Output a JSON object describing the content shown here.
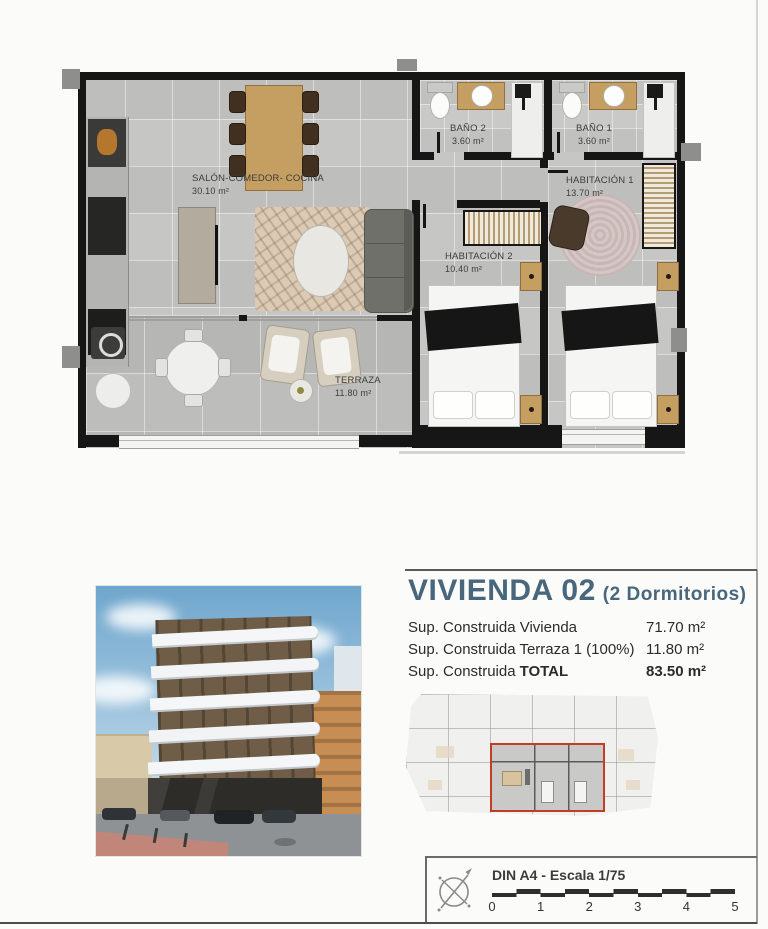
{
  "floorplan": {
    "rooms": [
      {
        "id": "salon",
        "name": "SALÓN-COMEDOR- COCINA",
        "area": "30.10 m²"
      },
      {
        "id": "terraza",
        "name": "TERRAZA",
        "area": "11.80 m²"
      },
      {
        "id": "bano2",
        "name": "BAÑO 2",
        "area": "3.60 m²"
      },
      {
        "id": "bano1",
        "name": "BAÑO 1",
        "area": "3.60 m²"
      },
      {
        "id": "hab1",
        "name": "HABITACIÓN 1",
        "area": "13.70 m²"
      },
      {
        "id": "hab2",
        "name": "HABITACIÓN 2",
        "area": "10.40 m²"
      }
    ]
  },
  "info": {
    "title": "VIVIENDA 02",
    "subtitle": "(2 Dormitorios)",
    "rows": [
      {
        "label": "Sup. Construida Vivienda",
        "value": "71.70 m²"
      },
      {
        "label": "Sup. Construida Terraza 1 (100%)",
        "value": "11.80 m²"
      },
      {
        "label": "Sup. Construida",
        "label_bold": "TOTAL",
        "value": "83.50 m²"
      }
    ]
  },
  "titleblock": {
    "sheet_label": "DIN A4 - Escala 1/75",
    "scale_ticks": [
      "0",
      "1",
      "2",
      "3",
      "4",
      "5"
    ]
  },
  "icons": {
    "compass": "north-arrow-compass"
  },
  "colors": {
    "accent_title": "#48677c",
    "highlight_red": "#c43b28",
    "wall_black": "#161616",
    "floor_gray": "#c6c6c4",
    "wood_tan": "#c59e62"
  }
}
